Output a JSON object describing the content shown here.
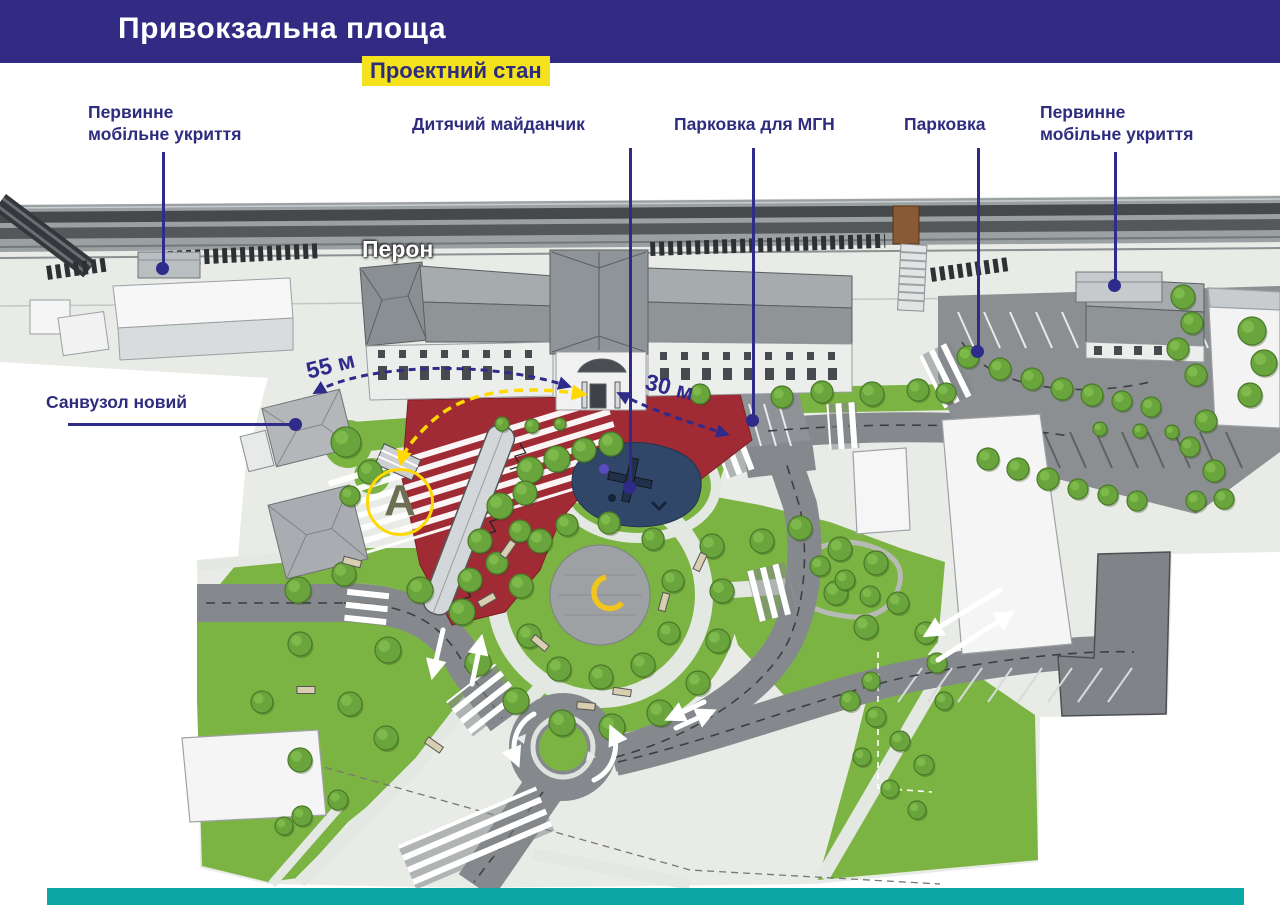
{
  "header": {
    "title": "Привокзальна площа",
    "subtitle": "Проектний стан"
  },
  "labels": {
    "shelter_left": "Первинне\nмобільне укриття",
    "playground": "Дитячий майданчик",
    "parking_mgn": "Парковка для МГН",
    "parking": "Парковка",
    "shelter_right": "Первинне\nмобільне укриття",
    "sanvuzol": "Санвузол новий",
    "peron": "Перон"
  },
  "measurements": {
    "dist_55": "55 м",
    "dist_30": "30 м"
  },
  "markers": {
    "point_a": "A"
  },
  "colors": {
    "header_bg": "#322b84",
    "label_navy": "#2e2c7d",
    "leader_navy": "#2f2b8a",
    "highlight_yellow": "#f3e21c",
    "footer_teal": "#0ca6a4",
    "plan_red": "#a12b34",
    "plan_green": "#7cb443",
    "playground_blue": "#31476a",
    "road_gray": "#85898d",
    "route_yellow": "#ffd900"
  }
}
